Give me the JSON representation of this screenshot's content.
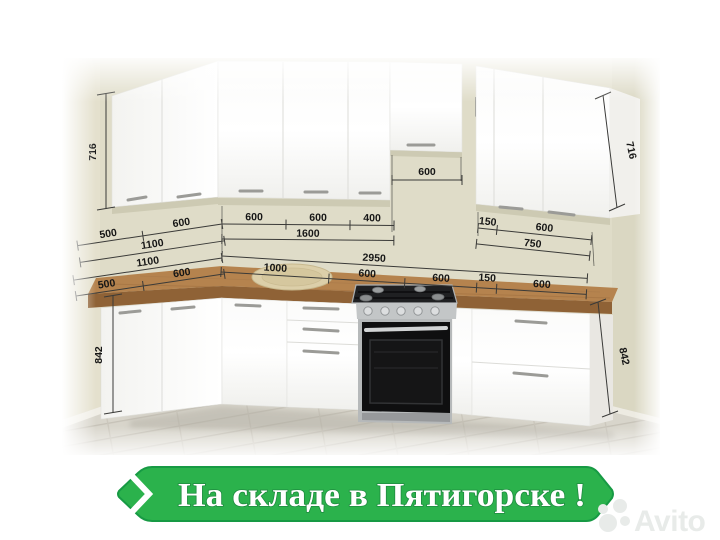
{
  "banner": {
    "label": "На складе в Пятигорске !"
  },
  "watermark": {
    "brand": "Avito"
  },
  "dimensions": {
    "upper_cabinet_height_left": "716",
    "upper_cabinet_height_right": "716",
    "base_cabinet_height_left": "842",
    "base_cabinet_height_right": "842",
    "hood_gap_width": "600",
    "upper_chain": {
      "left_wall": {
        "segments": [
          "500",
          "600"
        ],
        "total": "1100"
      },
      "main_wall": {
        "segments": [
          "600",
          "600",
          "400"
        ],
        "total": "1600"
      },
      "right_group": {
        "segments": [
          "150",
          "600"
        ],
        "total": "750"
      }
    },
    "lower_chain": {
      "left_wall": {
        "segments": [
          "500",
          "600"
        ],
        "total": "1100"
      },
      "main_wall": {
        "segments": [
          "1000",
          "600",
          "600",
          "150",
          "600"
        ],
        "total": "2950"
      }
    }
  },
  "colors": {
    "banner_green": "#2bb24c",
    "banner_outline_green": "#179a44",
    "wall_beige": "#dfdcc8",
    "countertop_wood": "#b5834e",
    "countertop_edge": "#8f6236",
    "floor_gray": "#d8d5cb",
    "watermark_gray": "#e8ebe9",
    "dimension_text": "#161616"
  }
}
